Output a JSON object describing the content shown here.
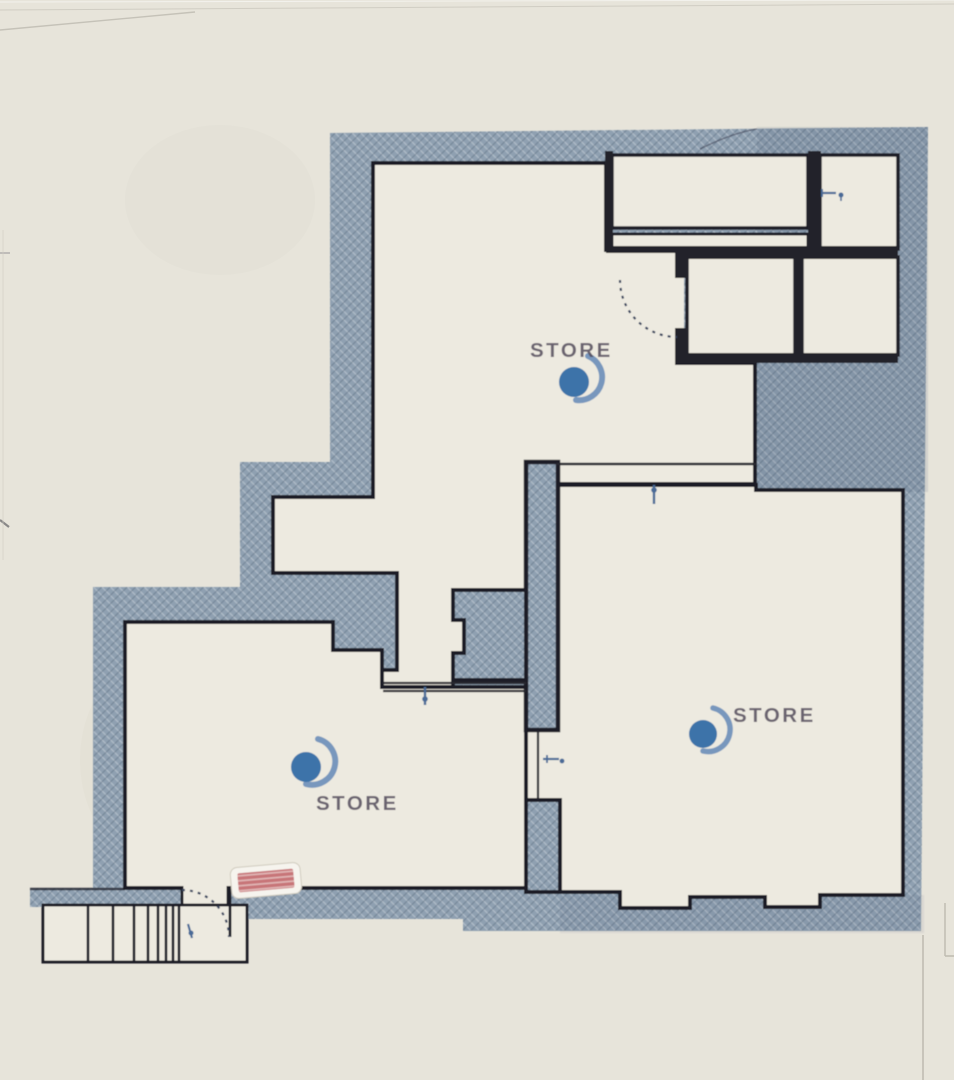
{
  "document": {
    "kind": "scanned floor plan",
    "paper_color": "#e7e4da"
  },
  "plan": {
    "wall_fill": "#8fa0b1",
    "wall_line": "#1f1f28",
    "floor_color": "#edeae0",
    "annotation_color": "#4a6b97"
  },
  "rooms": [
    {
      "id": "store-top",
      "label": "STORE"
    },
    {
      "id": "store-right",
      "label": "STORE"
    },
    {
      "id": "store-bottom-left",
      "label": "STORE"
    }
  ],
  "logo": {
    "name": "store-logo-icon",
    "shape": "circle-with-crescent",
    "circle_color": "#3c73a9",
    "swoosh_color": "#7897bd"
  },
  "entrance_sign": {
    "name": "red-entrance-sign",
    "fill": "#c2666b",
    "frame": "#f6f4ee"
  },
  "stairs": {
    "tread_count": 8
  },
  "annotations": {
    "items": [
      "door-tick-top-right-room",
      "door-tick-partition-top",
      "door-tick-partition-left",
      "door-tick-pillar-gap",
      "door-tick-stairs"
    ]
  }
}
